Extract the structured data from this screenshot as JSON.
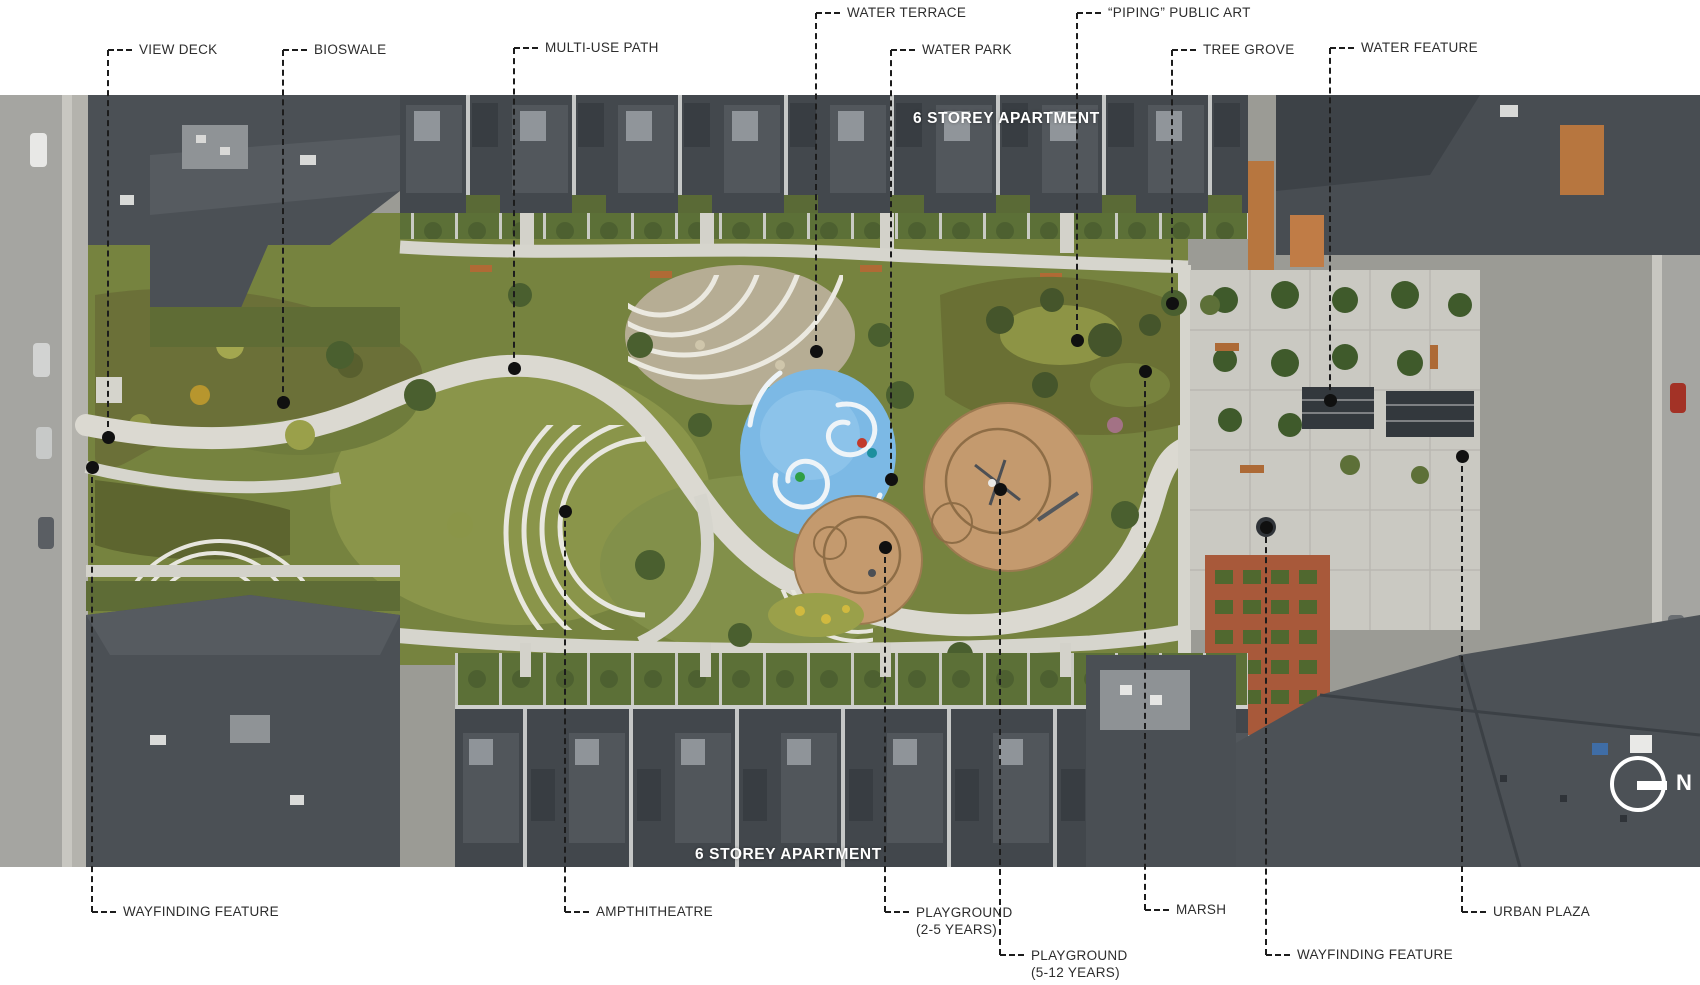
{
  "photo": {
    "apartment_top": "6 STOREY APARTMENT",
    "apartment_bottom": "6 STOREY APARTMENT",
    "compass_n": "N"
  },
  "callouts": {
    "view_deck": {
      "label": "VIEW DECK"
    },
    "bioswale": {
      "label": "BIOSWALE"
    },
    "multi_use_path": {
      "label": "MULTI-USE PATH"
    },
    "water_terrace": {
      "label": "WATER TERRACE"
    },
    "water_park": {
      "label": "WATER PARK"
    },
    "piping_public_art": {
      "label": "“PIPING” PUBLIC ART"
    },
    "tree_grove": {
      "label": "TREE GROVE"
    },
    "water_feature": {
      "label": "WATER FEATURE"
    },
    "wayfinding_left": {
      "label": "WAYFINDING FEATURE"
    },
    "ampthitheatre": {
      "label": "AMPTHITHEATRE"
    },
    "playground_2_5": {
      "label": "PLAYGROUND",
      "label2": "(2-5 YEARS)"
    },
    "playground_5_12": {
      "label": "PLAYGROUND",
      "label2": "(5-12 YEARS)"
    },
    "marsh": {
      "label": "MARSH"
    },
    "wayfinding_right": {
      "label": "WAYFINDING FEATURE"
    },
    "urban_plaza": {
      "label": "URBAN PLAZA"
    }
  },
  "palette": {
    "label_text": "#2d2d2d",
    "leader_line": "#1c1c1c",
    "photo_text": "#ffffff",
    "lawn_green": "#76833f",
    "planting_olive": "#6b7038",
    "roof_gray": "#42474c",
    "path_white": "#dbd9d1",
    "splash_pad_blue": "#7cb9e5",
    "playground_tan": "#c49a6e",
    "plaza_concrete": "#cac9c2",
    "brick_paving": "#a8593a"
  }
}
